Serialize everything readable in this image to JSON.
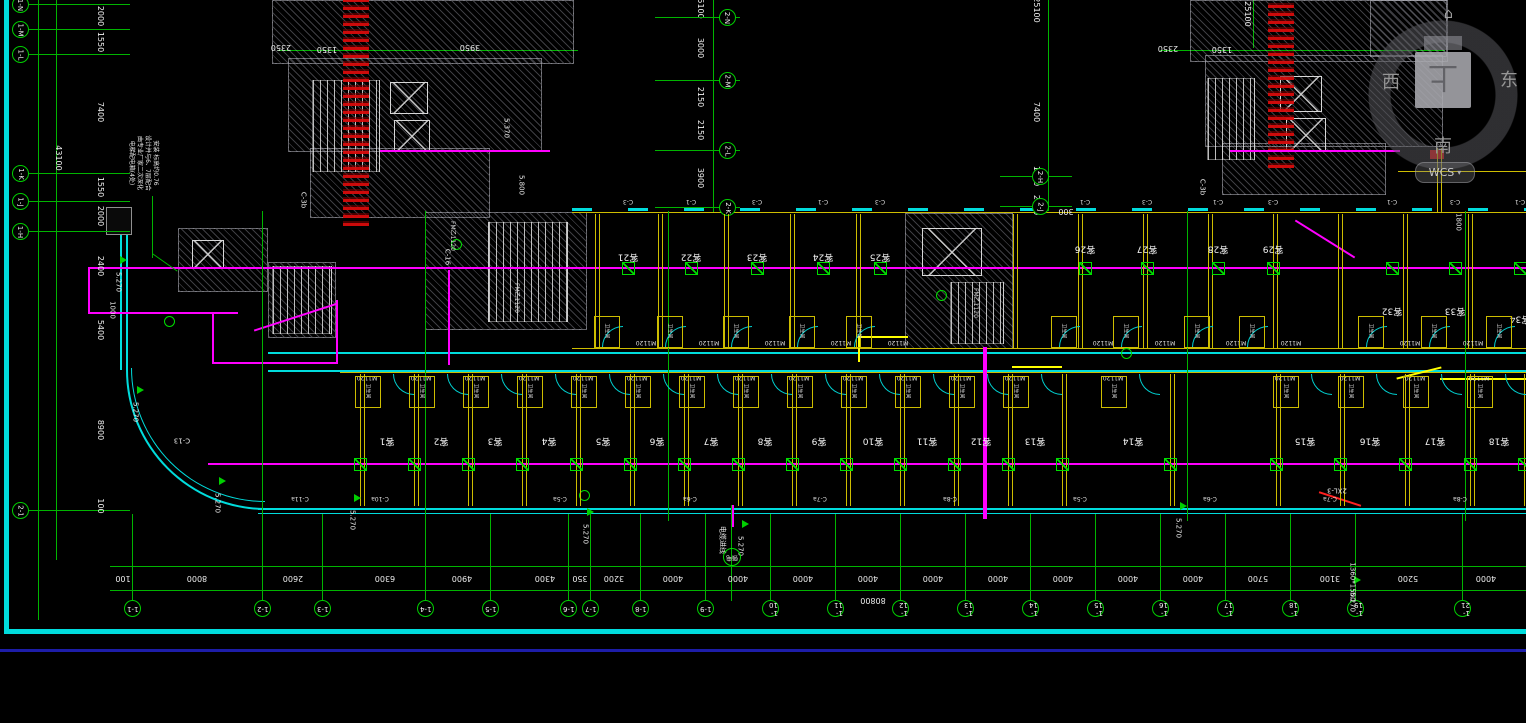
{
  "viewcube": {
    "west": "西",
    "east": "东",
    "south": "南",
    "top_face": "上",
    "wcs_label": "WCS",
    "dropdown_icon": "▾",
    "home_icon": "⌂"
  },
  "grid": {
    "left_bubbles": [
      {
        "y": 4,
        "l": "1-N"
      },
      {
        "y": 29,
        "l": "1-M"
      },
      {
        "y": 54,
        "l": "1-L"
      },
      {
        "y": 173,
        "l": "1-K"
      },
      {
        "y": 201,
        "l": "1-J"
      },
      {
        "y": 231,
        "l": "1-H"
      },
      {
        "y": 510,
        "l": "2-1"
      }
    ],
    "left_dims": [
      {
        "y": 16,
        "t": "2000"
      },
      {
        "y": 42,
        "t": "1550"
      },
      {
        "y": 112,
        "t": "7400"
      },
      {
        "y": 187,
        "t": "1550"
      },
      {
        "y": 216,
        "t": "2000"
      },
      {
        "y": 266,
        "t": "2400"
      },
      {
        "y": 330,
        "t": "5400"
      },
      {
        "y": 430,
        "t": "8900"
      },
      {
        "y": 506,
        "t": "100"
      }
    ],
    "left_total": {
      "x": 58,
      "y": 158,
      "t": "43100"
    },
    "bottom_dims": [
      {
        "x": 123,
        "t": "100"
      },
      {
        "x": 197,
        "t": "8000"
      },
      {
        "x": 293,
        "t": "2600"
      },
      {
        "x": 385,
        "t": "6300"
      },
      {
        "x": 462,
        "t": "4900"
      },
      {
        "x": 545,
        "t": "4300"
      },
      {
        "x": 580,
        "t": "350"
      },
      {
        "x": 614,
        "t": "3200"
      },
      {
        "x": 673,
        "t": "4000"
      },
      {
        "x": 738,
        "t": "4000"
      },
      {
        "x": 803,
        "t": "4000"
      },
      {
        "x": 868,
        "t": "4000"
      },
      {
        "x": 933,
        "t": "4000"
      },
      {
        "x": 998,
        "t": "4000"
      },
      {
        "x": 1063,
        "t": "4000"
      },
      {
        "x": 1128,
        "t": "4000"
      },
      {
        "x": 1193,
        "t": "4000"
      },
      {
        "x": 1258,
        "t": "5700"
      },
      {
        "x": 1330,
        "t": "3100"
      },
      {
        "x": 1408,
        "t": "5200"
      },
      {
        "x": 1486,
        "t": "4000"
      }
    ],
    "bottom_total": {
      "x": 873,
      "y": 600,
      "t": "80800"
    },
    "bottom_bubbles": [
      {
        "x": 132,
        "l": "1-1"
      },
      {
        "x": 262,
        "l": "1-2"
      },
      {
        "x": 322,
        "l": "1-3"
      },
      {
        "x": 425,
        "l": "1-4"
      },
      {
        "x": 490,
        "l": "1-5"
      },
      {
        "x": 568,
        "l": "1-6"
      },
      {
        "x": 590,
        "l": "1-7"
      },
      {
        "x": 640,
        "l": "1-8"
      },
      {
        "x": 705,
        "l": "1-9"
      },
      {
        "x": 770,
        "l": "1-10"
      },
      {
        "x": 835,
        "l": "1-11"
      },
      {
        "x": 900,
        "l": "1-12"
      },
      {
        "x": 965,
        "l": "1-13"
      },
      {
        "x": 1030,
        "l": "1-14"
      },
      {
        "x": 1095,
        "l": "1-15"
      },
      {
        "x": 1160,
        "l": "1-16"
      },
      {
        "x": 1225,
        "l": "1-17"
      },
      {
        "x": 1290,
        "l": "1-18"
      },
      {
        "x": 1355,
        "l": "1-19"
      },
      {
        "x": 1462,
        "l": "1-21"
      }
    ],
    "mid_a_dims": [
      {
        "y": 6,
        "t": "25100"
      },
      {
        "y": 48,
        "t": "3000"
      },
      {
        "y": 97,
        "t": "2150"
      },
      {
        "y": 130,
        "t": "2150"
      },
      {
        "y": 178,
        "t": "3900"
      }
    ],
    "mid_a_bubbles": [
      {
        "y": 17,
        "l": "2-N"
      },
      {
        "y": 80,
        "l": "2-M"
      },
      {
        "y": 150,
        "l": "2-L"
      },
      {
        "y": 207,
        "l": "2-K"
      }
    ],
    "mid_b_dims": [
      {
        "y": 10,
        "t": "25100"
      },
      {
        "y": 112,
        "t": "7400"
      },
      {
        "y": 176,
        "t": "1550"
      },
      {
        "y": 205,
        "t": "2000"
      }
    ],
    "mid_b_bubbles": [
      {
        "y": 176,
        "l": "2-H"
      },
      {
        "y": 206,
        "l": "2-J"
      }
    ],
    "mid_c_dim": {
      "x": 1247,
      "y": 14,
      "t": "25100"
    },
    "top_dims": [
      {
        "x": 281,
        "y": 47,
        "t": "2350"
      },
      {
        "x": 327,
        "y": 49,
        "t": "1350"
      },
      {
        "x": 470,
        "y": 47,
        "t": "3950"
      },
      {
        "x": 1168,
        "y": 48,
        "t": "2350"
      },
      {
        "x": 1222,
        "y": 49,
        "t": "1350"
      },
      {
        "x": 1066,
        "y": 211,
        "t": "300"
      }
    ]
  },
  "plan": {
    "rooms_top": [
      {
        "x": 628,
        "y": 256,
        "label": "客21"
      },
      {
        "x": 691,
        "y": 256,
        "label": "客22"
      },
      {
        "x": 757,
        "y": 256,
        "label": "客23"
      },
      {
        "x": 823,
        "y": 256,
        "label": "客24"
      },
      {
        "x": 880,
        "y": 256,
        "label": "客25"
      },
      {
        "x": 1085,
        "y": 248,
        "label": "客26"
      },
      {
        "x": 1147,
        "y": 248,
        "label": "客27"
      },
      {
        "x": 1218,
        "y": 248,
        "label": "客28"
      },
      {
        "x": 1273,
        "y": 248,
        "label": "客29"
      },
      {
        "x": 1392,
        "y": 310,
        "label": "客32"
      },
      {
        "x": 1455,
        "y": 310,
        "label": "客33"
      },
      {
        "x": 1520,
        "y": 318,
        "label": "客34"
      }
    ],
    "walls_top": [
      595,
      658,
      724,
      790,
      856,
      1013,
      1078,
      1143,
      1208,
      1273,
      1338,
      1403,
      1468
    ],
    "rooms_bottom": [
      {
        "x": 387,
        "label": "客1"
      },
      {
        "x": 441,
        "label": "客2"
      },
      {
        "x": 495,
        "label": "客3"
      },
      {
        "x": 549,
        "label": "客4"
      },
      {
        "x": 603,
        "label": "客5"
      },
      {
        "x": 657,
        "label": "客6"
      },
      {
        "x": 711,
        "label": "客7"
      },
      {
        "x": 765,
        "label": "客8"
      },
      {
        "x": 819,
        "label": "客9"
      },
      {
        "x": 873,
        "label": "客10"
      },
      {
        "x": 927,
        "label": "客11"
      },
      {
        "x": 981,
        "label": "客12"
      },
      {
        "x": 1035,
        "label": "客13"
      },
      {
        "x": 1133,
        "label": "客14"
      },
      {
        "x": 1305,
        "label": "客15"
      },
      {
        "x": 1370,
        "label": "客16"
      },
      {
        "x": 1435,
        "label": "客17"
      },
      {
        "x": 1499,
        "label": "客18"
      }
    ],
    "walls_bottom": [
      360,
      414,
      468,
      522,
      576,
      630,
      684,
      738,
      792,
      846,
      900,
      954,
      1008,
      1062,
      1170,
      1276,
      1340,
      1405,
      1470,
      1524
    ],
    "door_label": "M1120",
    "fire_door_label": "FM乙1120",
    "fire_door_positions": [
      {
        "x": 452,
        "y": 236
      },
      {
        "x": 516,
        "y": 298
      },
      {
        "x": 975,
        "y": 303
      }
    ],
    "bath_label": "卫生间",
    "top_window_label_pattern": [
      "C-3",
      "C-1"
    ],
    "window_labels": [
      {
        "x": 300,
        "t": "C-11a"
      },
      {
        "x": 380,
        "t": "C-10a"
      },
      {
        "x": 560,
        "t": "C-5a"
      },
      {
        "x": 690,
        "t": "C-6a"
      },
      {
        "x": 820,
        "t": "C-7a"
      },
      {
        "x": 950,
        "t": "C-8a"
      },
      {
        "x": 1080,
        "t": "C-5a"
      },
      {
        "x": 1210,
        "t": "C-6a"
      },
      {
        "x": 1330,
        "t": "C-7a"
      },
      {
        "x": 1460,
        "t": "C-8a"
      }
    ],
    "elevations": [
      {
        "x": 118,
        "y": 282,
        "t": "5.270"
      },
      {
        "x": 135,
        "y": 412,
        "t": "5.270"
      },
      {
        "x": 217,
        "y": 503,
        "t": "5.270"
      },
      {
        "x": 352,
        "y": 520,
        "t": "5.270"
      },
      {
        "x": 585,
        "y": 534,
        "t": "5.270"
      },
      {
        "x": 740,
        "y": 546,
        "t": "5.270"
      },
      {
        "x": 1178,
        "y": 528,
        "t": "5.270"
      },
      {
        "x": 1352,
        "y": 602,
        "t": "5.270"
      }
    ],
    "notes": [
      {
        "x": 506,
        "y": 128,
        "t": "5.370",
        "r": 90
      },
      {
        "x": 521,
        "y": 185,
        "t": "5.800",
        "r": 90
      },
      {
        "x": 112,
        "y": 310,
        "t": "1000",
        "r": 90
      },
      {
        "x": 1352,
        "y": 582,
        "t": "1360*1500",
        "r": 90
      },
      {
        "x": 1337,
        "y": 490,
        "t": "2XL-3",
        "r": 180
      },
      {
        "x": 447,
        "y": 257,
        "t": "C-16",
        "r": 90
      },
      {
        "x": 303,
        "y": 200,
        "t": "C-3b",
        "r": 90
      },
      {
        "x": 1202,
        "y": 187,
        "t": "C-3b",
        "r": 90
      },
      {
        "x": 182,
        "y": 440,
        "t": "C-13",
        "r": 180
      },
      {
        "x": 722,
        "y": 540,
        "t": "电缆进线",
        "r": 90
      },
      {
        "x": 1458,
        "y": 222,
        "t": "1800",
        "r": 90
      }
    ],
    "power_riser": "强电",
    "annotation_lines": [
      "电梯配电箱(4处)",
      "由专业厂家二次深化",
      "设计并与6、7层配合",
      "安装 标高约0.76"
    ]
  }
}
